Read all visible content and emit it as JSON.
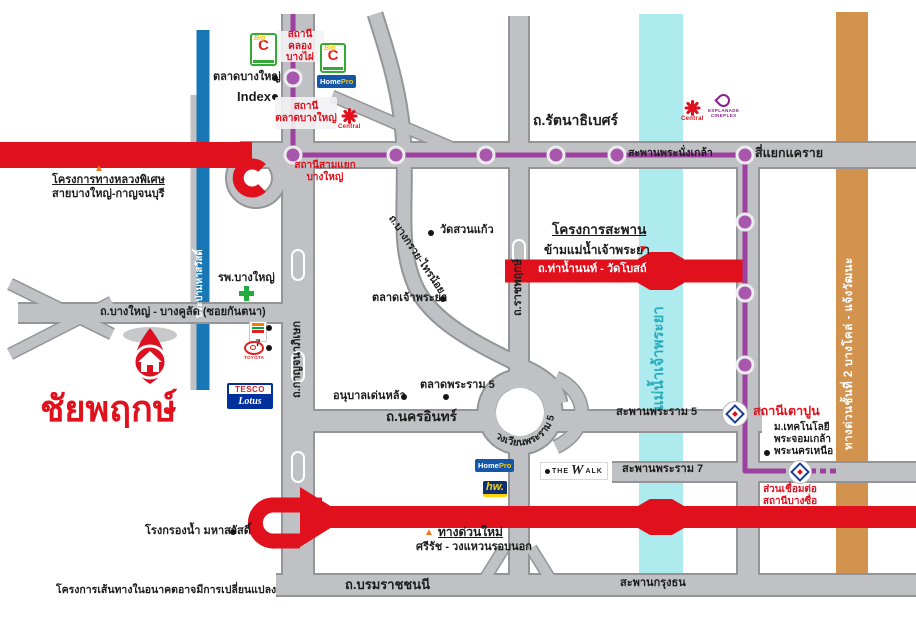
{
  "project": {
    "name": "ชัยพฤกษ์",
    "disclaimer": "โครงการเส้นทางในอนาคตอาจมีการเปลี่ยนแปลง"
  },
  "colors": {
    "road_gray": "#bfc1c4",
    "road_edge": "#939598",
    "highway_red": "#e0101c",
    "river_cyan": "#aeebee",
    "canal_blue": "#1878b6",
    "expressway_orange": "#d2934f",
    "mrt_purple": "#9d41a0"
  },
  "roads": {
    "rattanathibet": "ถ.รัตนาธิเบศร์",
    "kanchanaphisek": "ถ.กาญจนาภิเษก",
    "ratchaphruek": "ถ.ราชพฤกษ์",
    "bang_kruai_sai_noi": "ถ.บางกรวย-ไทรน้อย",
    "bang_yai_bang_khulat": "ถ.บางใหญ่ - บางคูลัด (ซอยกันตนา)",
    "nakhon_in": "ถ.นครอินทร์",
    "rama5_circle": "วงเวียนพระราม 5",
    "rama5_bridge": "สะพานพระราม 5",
    "rama7_bridge": "สะพานพระราม 7",
    "krung_thon_bridge": "สะพานกรุงธน",
    "phra_nangklao_bridge": "สะพานพระนั่งเกล้า",
    "khae_rai_intersection": "สี่แยกแคราย",
    "tha_nam_non_wat_bot": "ถ.ท่าน้ำนนท์ - วัดโบสถ์",
    "borommaratchachonnani": "ถ.บรมราชชนนี",
    "stage2_expressway": "ทางด่วนชั้นที่ 2 บางโคล่ - แจ้งวัฒนะ",
    "canal": "ประปามหาสวัสดิ์",
    "river": "แม่น้ำเจ้าพระยา"
  },
  "projects": {
    "motorway_line1": "โครงการทางหลวงพิเศษ",
    "motorway_line2": "สายบางใหญ่-กาญจนบุรี",
    "bridge_line1": "โครงการสะพาน",
    "bridge_line2": "ข้ามแม่น้ำเจ้าพระยา",
    "new_expressway_line1": "ทางด่วนใหม่",
    "new_expressway_line2": "ศรีรัช - วงแหวนรอบนอก",
    "bang_sue_link": "ส่วนเชื่อมต่อ\nสถานีบางซื่อ"
  },
  "stations": {
    "khlong_bang_phai": "สถานี\nคลองบางไผ่",
    "talat_bang_yai": "สถานี\nตลาดบางใหญ่",
    "sam_yaek_bang_yai": "สถานีสามแยก\nบางใหญ่",
    "tao_pun": "สถานีเตาปูน"
  },
  "places": {
    "talat_bang_yai_market": "ตลาดบางใหญ่",
    "index": "Index",
    "bang_yai_hospital": "รพ.บางใหญ่",
    "wat_suan_kaew": "วัดสวนแก้ว",
    "talat_chao_phraya": "ตลาดเจ้าพระยา",
    "anuban_denla": "อนุบาลเด่นหล้า",
    "talat_rama5": "ตลาดพระราม 5",
    "kmutnb": "ม.เทคโนโลยี\nพระจอมเกล้า\nพระนครเหนือ",
    "water_plant": "โรงกรองน้ำ มหาสวัสดิ์"
  },
  "logos": {
    "big_c_small": "Big",
    "big_c_large": "C",
    "homepro_home": "Home",
    "homepro_pro": "Pro",
    "central": "Central",
    "esplanade_line1": "ESPLANADE",
    "esplanade_line2": "CINEPLEX",
    "seven": "7",
    "toyota": "TOYOTA",
    "tesco": "TESCO",
    "lotus": "Lotus",
    "hw": "hw.",
    "the": "THE",
    "walk_w": "W",
    "walk_rest": "ALK"
  }
}
